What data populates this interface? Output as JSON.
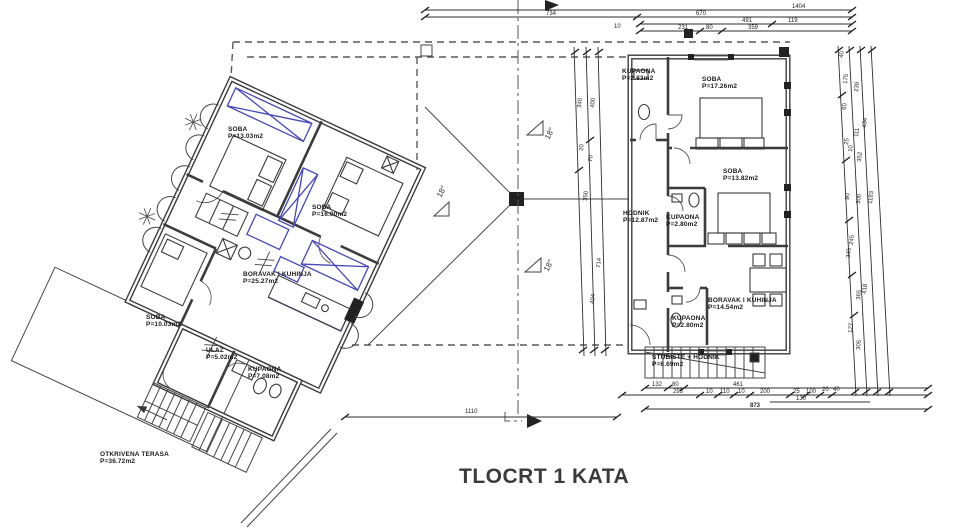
{
  "title": "TLOCRT 1 KATA",
  "colors": {
    "ink": "#3c3c3c",
    "furniture_accent": "#4747b8",
    "dashed_roof": "#5a5a5a",
    "background": "#ffffff"
  },
  "roof": {
    "slopes": [
      "18°",
      "18°",
      "18°"
    ]
  },
  "rooms": {
    "left": [
      {
        "name": "SOBA",
        "area": "P=13.03m2"
      },
      {
        "name": "SOBA",
        "area": "P=16.00m2"
      },
      {
        "name": "BORAVAK  I  KUHINJA",
        "area": "P=25.27m2"
      },
      {
        "name": "SOBA",
        "area": "P=10.03m2"
      },
      {
        "name": "ULAZ",
        "area": "P=5.02m2"
      },
      {
        "name": "KUPAONA",
        "area": "P=7.08m2"
      },
      {
        "name": "OTKRIVENA  TERASA",
        "area": "P=36.72m2"
      }
    ],
    "right": [
      {
        "name": "KUPAONA",
        "area": "P=2.83m2"
      },
      {
        "name": "SOBA",
        "area": "P=17.26m2"
      },
      {
        "name": "SOBA",
        "area": "P=13.82m2"
      },
      {
        "name": "HODNIK",
        "area": "P=12.87m2"
      },
      {
        "name": "KUPAONA",
        "area": "P=2.80m2"
      },
      {
        "name": "BORAVAK  I  KUHINJA",
        "area": "P=14.54m2"
      },
      {
        "name": "KUPAONA",
        "area": "P=2.80m2"
      },
      {
        "name": "STUBIŠTE + HODNIK",
        "area": "P=6.69m2"
      }
    ]
  },
  "dims": {
    "top": [
      "1404",
      "734",
      "670",
      "491",
      "119",
      "231",
      "80",
      "359",
      "10"
    ],
    "left_chain": [
      "340",
      "400",
      "20",
      "70",
      "350",
      "714",
      "404"
    ],
    "right_chain": [
      "40",
      "175",
      "239",
      "434",
      "60",
      "111",
      "25",
      "10",
      "352",
      "90",
      "300",
      "1183",
      "245",
      "345",
      "418",
      "365",
      "127",
      "305"
    ],
    "bottom": [
      "132",
      "80",
      "461",
      "293",
      "10",
      "110",
      "10",
      "200",
      "25",
      "100",
      "20",
      "40",
      "130",
      "873"
    ],
    "site": [
      "1110"
    ]
  }
}
